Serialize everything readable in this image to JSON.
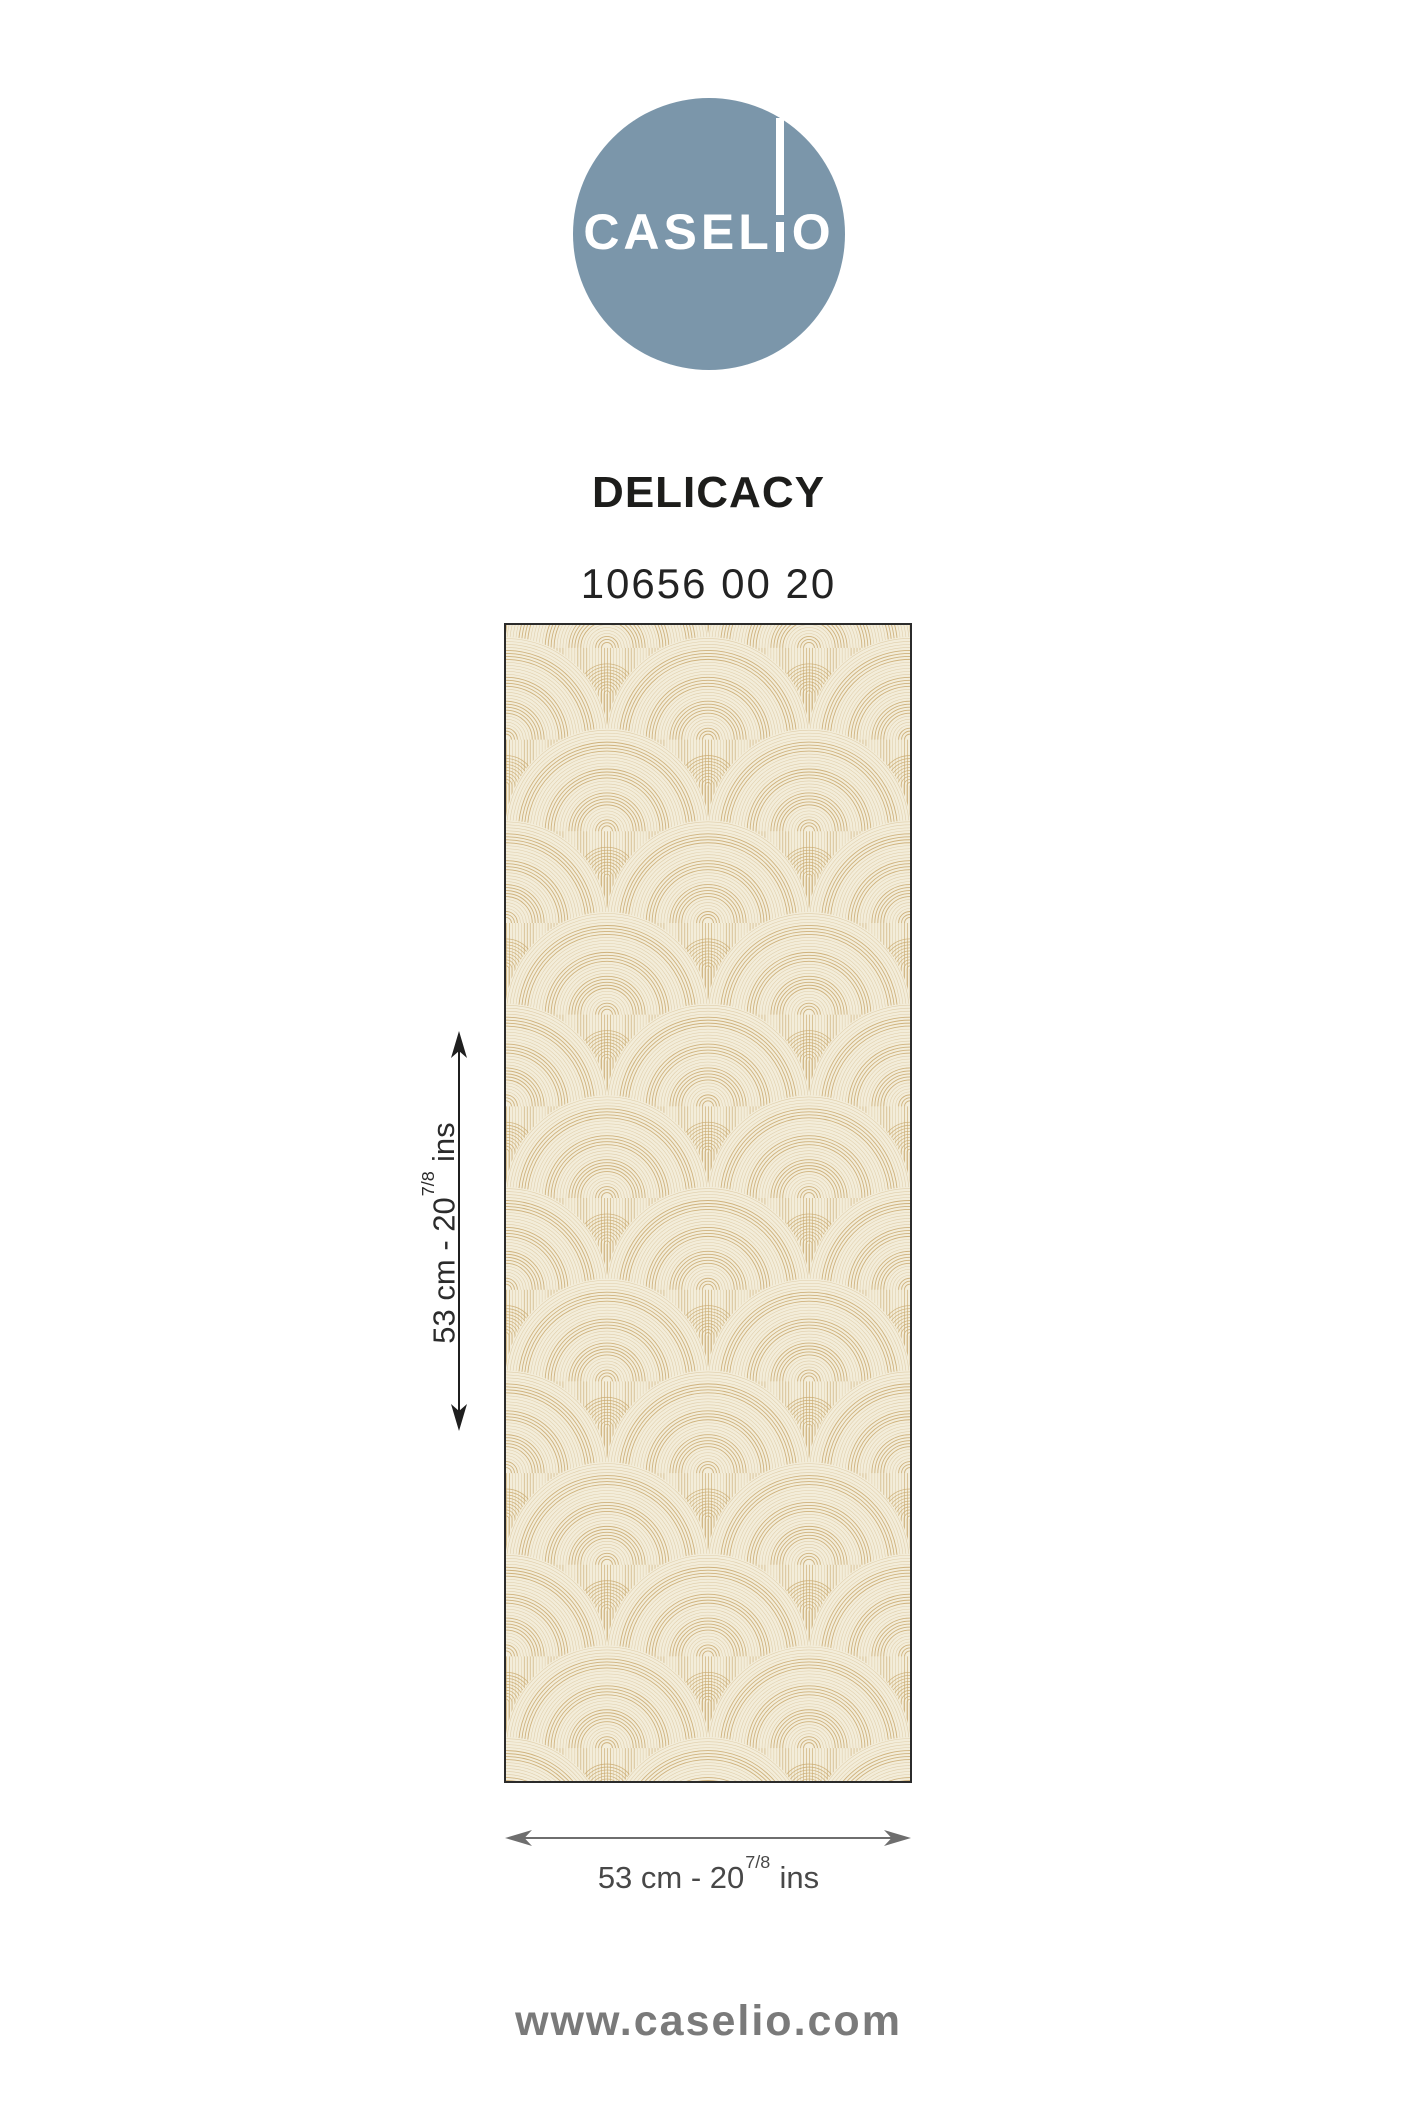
{
  "brand": {
    "name": "CASELIO",
    "logo_text_left": "CASEL",
    "logo_text_right": "O",
    "logo_circle_color": "#7b96aa",
    "website": "www.caselio.com"
  },
  "product": {
    "collection": "DELICACY",
    "reference": "10656 00 20"
  },
  "dimensions": {
    "height_label": {
      "prefix": "53 cm - 20",
      "fraction": "7/8",
      "unit": "ins"
    },
    "width_label": {
      "prefix": "53 cm - 20",
      "fraction": "7/8",
      "unit": "ins"
    },
    "height_arrow_color": "#1f1f1f",
    "width_arrow_color": "#6e6e6e"
  },
  "wallpaper": {
    "background_color": "#f3edda",
    "line_color": "#c8a76c",
    "border_color": "#2b2b2b"
  }
}
